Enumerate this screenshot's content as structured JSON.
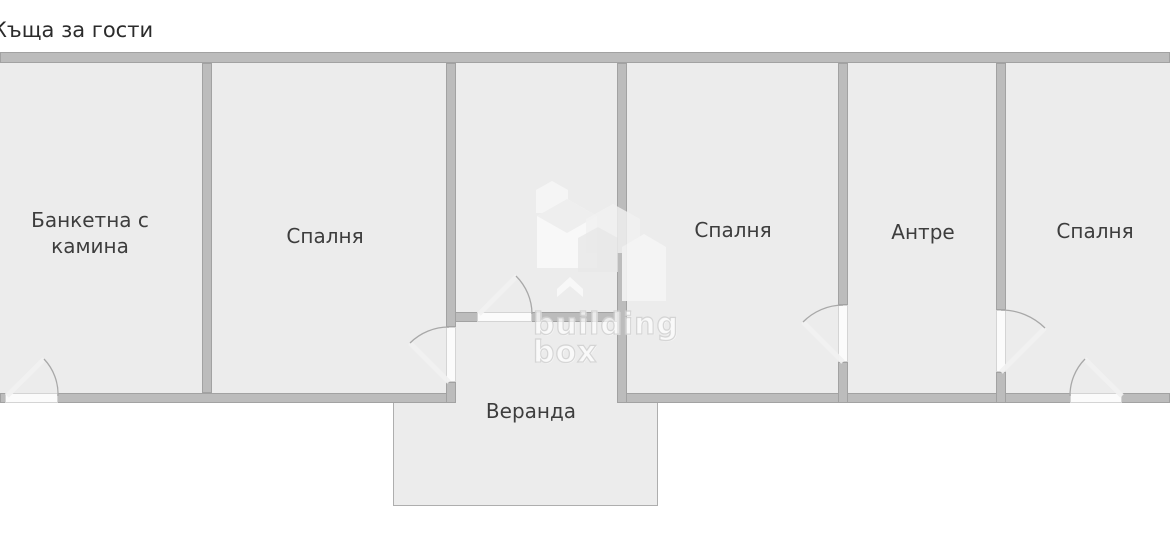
{
  "title": "Къща за гости",
  "rooms": [
    {
      "label": "Банкетна с камина"
    },
    {
      "label": "Спалня"
    },
    {
      "label": "Спалня"
    },
    {
      "label": "Антре"
    },
    {
      "label": "Спалня"
    },
    {
      "label": "Веранда"
    }
  ],
  "watermark": {
    "line1": "building",
    "line2": "box"
  },
  "colors": {
    "wall": "#bcbcbc",
    "wall_edge": "#a2a2a2",
    "room_fill": "#ececec",
    "door_gap": "#fbfbfb",
    "arc": "#a8a8a8",
    "leaf": "#f2f2f2",
    "title": "#2b2b2b",
    "label": "#3d3d3d",
    "veranda_border": "#aeaeae"
  }
}
